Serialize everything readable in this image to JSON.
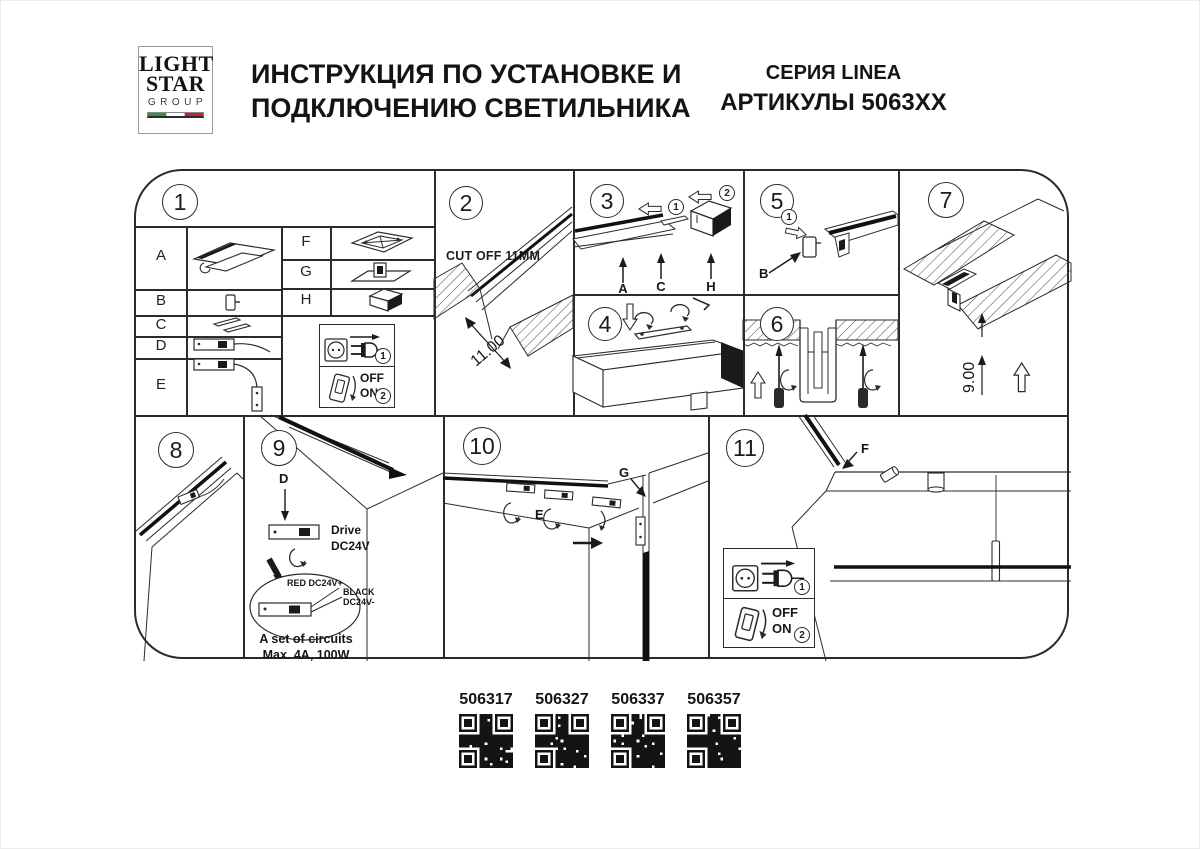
{
  "header": {
    "logo": {
      "line1": "LIGHT",
      "line2": "STAR",
      "line3": "GROUP"
    },
    "flag": {
      "green": "#37913d",
      "white": "#ffffff",
      "red": "#c8202a"
    },
    "title_line1": "ИНСТРУКЦИЯ ПО УСТАНОВКЕ И",
    "title_line2": "ПОДКЛЮЧЕНИЮ СВЕТИЛЬНИКА",
    "series": "СЕРИЯ LINEA",
    "articles": "АРТИКУЛЫ 5063XX"
  },
  "panels": {
    "p1": {
      "number": "1",
      "letters_left": [
        "A",
        "B",
        "C",
        "D",
        "E"
      ],
      "letters_right": [
        "F",
        "G",
        "H"
      ]
    },
    "p2": {
      "number": "2",
      "note": "CUT OFF 11MM",
      "dim": "11.00"
    },
    "p3": {
      "number": "3",
      "steps": [
        "1",
        "2"
      ],
      "labels": [
        "A",
        "C",
        "H"
      ]
    },
    "p4": {
      "number": "4"
    },
    "p5": {
      "number": "5",
      "step": "1",
      "label": "B"
    },
    "p6": {
      "number": "6"
    },
    "p7": {
      "number": "7",
      "dim": "9.00"
    },
    "p8": {
      "number": "8"
    },
    "p9": {
      "number": "9",
      "label": "D",
      "drive_line1": "Drive",
      "drive_line2": "DC24V",
      "wire_red": "RED DC24V+",
      "wire_black_line1": "BLACK",
      "wire_black_line2": "DC24V-",
      "circuits_line1": "A set of circuits",
      "circuits_line2": "Max. 4A, 100W"
    },
    "p10": {
      "number": "10",
      "labels": [
        "E",
        "G"
      ]
    },
    "p11": {
      "number": "11",
      "label": "F"
    }
  },
  "power_box": {
    "step_plug": "1",
    "step_switch": "2",
    "off_label": "OFF",
    "on_label": "ON"
  },
  "qr_codes": [
    {
      "code": "506317"
    },
    {
      "code": "506327"
    },
    {
      "code": "506337"
    },
    {
      "code": "506357"
    }
  ]
}
